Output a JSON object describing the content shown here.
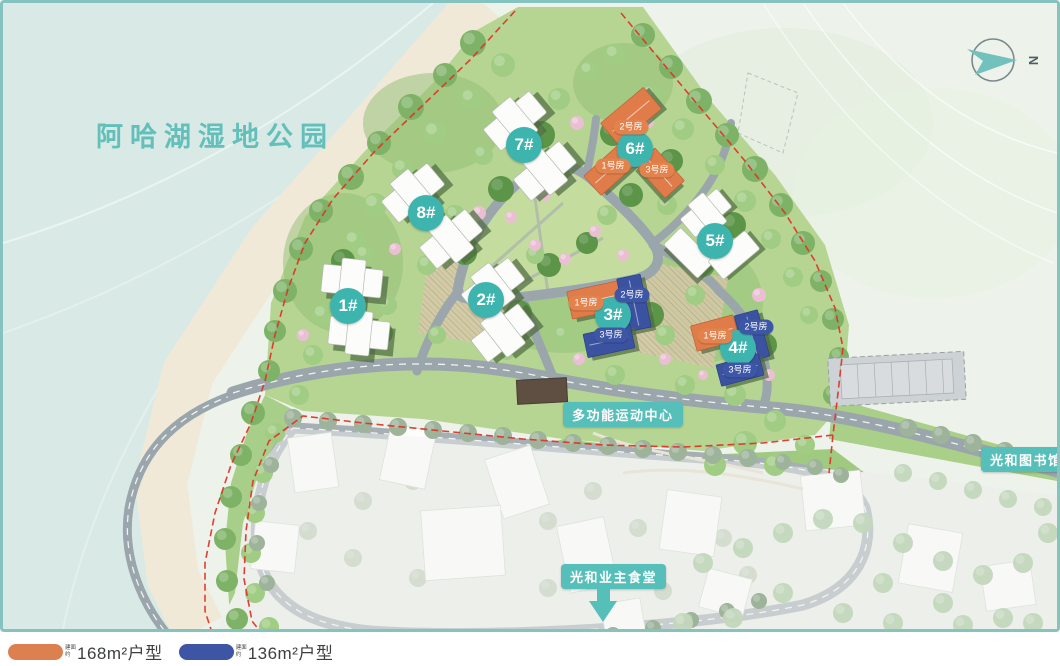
{
  "map": {
    "park_label": "阿哈湖湿地公园",
    "compass_letter": "N",
    "buildings": [
      {
        "label": "1#"
      },
      {
        "label": "2#"
      },
      {
        "label": "3#"
      },
      {
        "label": "4#"
      },
      {
        "label": "5#"
      },
      {
        "label": "6#"
      },
      {
        "label": "7#"
      },
      {
        "label": "8#"
      }
    ],
    "unit_pills": [
      {
        "building": "6#",
        "label": "2号房",
        "type": "orange"
      },
      {
        "building": "6#",
        "label": "1号房",
        "type": "orange"
      },
      {
        "building": "6#",
        "label": "3号房",
        "type": "orange"
      },
      {
        "building": "3#",
        "label": "1号房",
        "type": "orange"
      },
      {
        "building": "3#",
        "label": "2号房",
        "type": "blue"
      },
      {
        "building": "3#",
        "label": "3号房",
        "type": "blue"
      },
      {
        "building": "4#",
        "label": "1号房",
        "type": "orange"
      },
      {
        "building": "4#",
        "label": "2号房",
        "type": "blue"
      },
      {
        "building": "4#",
        "label": "3号房",
        "type": "blue"
      }
    ],
    "poi": {
      "sports_center": "多功能运动中心",
      "library": "光和图书馆",
      "canteen": "光和业主食堂"
    }
  },
  "legend": {
    "items": [
      {
        "prefix": "建面约",
        "label": "168m²户型",
        "color": "#DD8050"
      },
      {
        "prefix": "建面约",
        "label": "136m²户型",
        "color": "#3D55A4"
      }
    ]
  },
  "colors": {
    "teal_accent": "#3EB4AF",
    "poi_teal": "#57BFB9",
    "orange": "#DD8050",
    "blue": "#3D55A4",
    "boundary_red": "#E03528",
    "park_text": "#62BFB9"
  }
}
